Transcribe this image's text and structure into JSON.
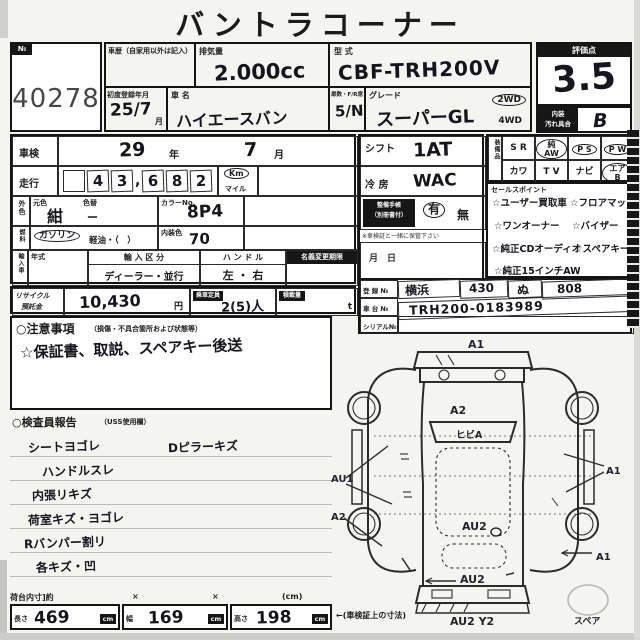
{
  "title": "バントラコーナー",
  "lot": {
    "tag": "№",
    "number": "40278"
  },
  "score": {
    "label": "評価点",
    "value": "3.5",
    "interior_label_1": "内装",
    "interior_label_2": "汚れ具合",
    "interior_value": "B"
  },
  "top": {
    "history_label": "車歴（自家用以外は記入）",
    "disp_label": "排気量",
    "disp_value": "2.000cc",
    "model_label": "型 式",
    "model_value": "CBF-TRH200V",
    "firstreg_label": "初度登録年月",
    "firstreg_value": "25/7",
    "firstreg_unit": "月",
    "name_label": "車 名",
    "name_value": "ハイエースバン",
    "doors_label": "扉数・F/R席",
    "doors_value": "5/N",
    "grade_label": "グレード",
    "grade_value": "スーパーGL",
    "wd2": "2WD",
    "wd4": "4WD"
  },
  "left": {
    "shaken_label": "車検",
    "shaken_year": "29",
    "unit_year": "年",
    "shaken_month": "7",
    "unit_month": "月",
    "run_label": "走行",
    "run_digits": [
      "4",
      "3",
      "6",
      "8",
      "2"
    ],
    "run_comma": ",",
    "unit_km": "Km",
    "unit_mile": "マイル",
    "color_label": "外色",
    "base_label": "元色",
    "base_value": "紺",
    "recolor_label": "色替",
    "recolor_value": "ー",
    "colorno_label": "カラーNo.",
    "colorno_value": "8P4",
    "fuel_label": "燃料",
    "gasoline": "ガソリン",
    "diesel": "軽油・（　）",
    "intcolor_label": "内装色",
    "intcolor_value": "70",
    "import_label": "輸入車",
    "year_label": "年式",
    "importkind_label": "輸 入 区 分",
    "importkind_value": "ディーラー・並行",
    "handle_label": "ハ ン ド ル",
    "handle_value": "左 ・ 右",
    "transfer_label": "名義変更期限",
    "transfer_value": "月　日"
  },
  "mid": {
    "shift_label": "シフト",
    "shift_value": "1AT",
    "ac_label": "冷 房",
    "ac_value": "WAC",
    "record_label_1": "整備手帳",
    "record_label_2": "（別冊書付）",
    "record_yes": "有",
    "record_no": "無",
    "record_note": "※車検証と一緒に保管下さい"
  },
  "equip": {
    "label": "装備品",
    "row1": [
      "S R",
      "純AW",
      "P S",
      "P W"
    ],
    "row2": [
      "カワ",
      "T V",
      "ナビ",
      "エアB"
    ]
  },
  "sales": {
    "label": "セールスポイント",
    "left": [
      "☆ユーザー買取車",
      "☆ワンオーナー",
      "☆純正CDオーディオ",
      "☆純正15インチAW"
    ],
    "right": [
      "☆フロアマット",
      "☆バイザー",
      "☆スペアキー"
    ]
  },
  "reg": {
    "reg_label": "登 録 №",
    "area": "横浜",
    "class_no": "430",
    "kana": "ぬ",
    "number": "808",
    "chassis_label": "車 台 №",
    "chassis": "TRH200-0183989",
    "serial_label": "シリアル№",
    "serial": ""
  },
  "recycle": {
    "label1": "リサイクル",
    "label2": "預託金",
    "amount": "10,430",
    "yen": "円",
    "cap_label": "乗車定員",
    "cap_value": "2(5)人",
    "load_label": "積載量",
    "load_unit": "t"
  },
  "caution": {
    "header": "○注意事項",
    "header_sub": "（損傷・不具合箇所および状態等）",
    "note": "☆保証書、取説、スペアキー後送"
  },
  "inspector": {
    "header": "○検査員報告",
    "header_sub": "（USS使用欄）",
    "items_left": [
      "シートヨゴレ",
      "ハンドルスレ",
      "内張リキズ",
      "荷室キズ・ヨゴレ",
      "Rバンパー割リ",
      "各キズ・凹"
    ],
    "item_right": "Dピラーキズ"
  },
  "dims": {
    "header": "荷台内寸]約",
    "x1": "×",
    "x2": "×",
    "unit_hdr": "(cm)",
    "len_label": "長さ",
    "len": "469",
    "wid_label": "幅",
    "wid": "169",
    "hei_label": "高さ",
    "hei": "198",
    "cm": "cm",
    "note": "←(車検証上の寸法)"
  },
  "diagram": {
    "front": "A1",
    "hood": "A2",
    "windshield": "ヒビA",
    "left_mid": "AU1",
    "left_rear": "A2",
    "center": "AU2",
    "rear": "AU2",
    "bottom": "AU2 Y2",
    "right_mid": "A1",
    "right_low": "A1",
    "spare": "スペア"
  }
}
